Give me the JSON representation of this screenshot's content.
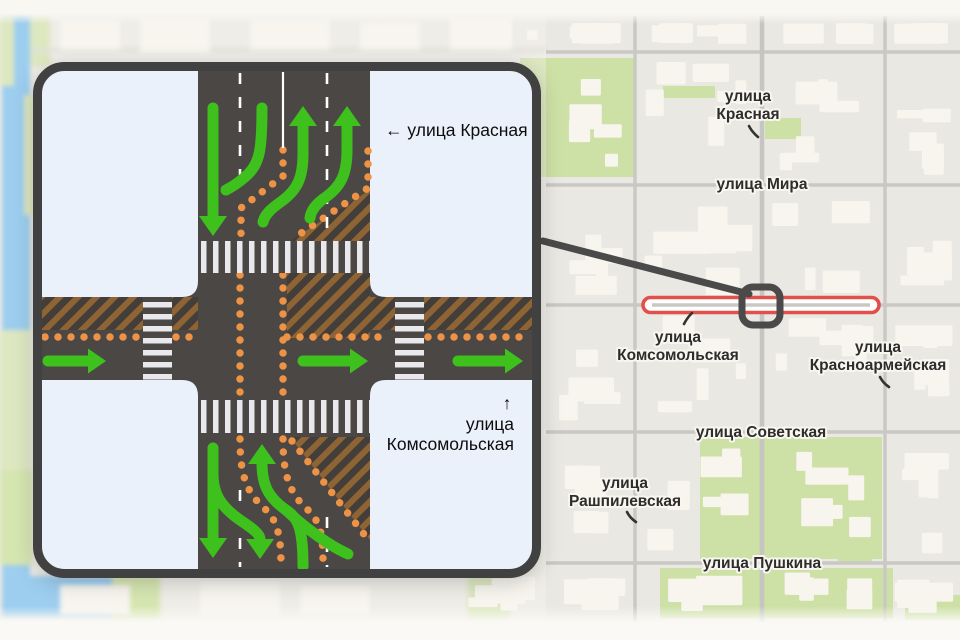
{
  "inset": {
    "label_krasnaya": "← улица Красная",
    "label_komsomolskaya_arrow": "↑",
    "label_komsomolskaya_line1": "улица",
    "label_komsomolskaya_line2": "Комсомольская"
  },
  "map": {
    "label_krasnaya_line1": "улица",
    "label_krasnaya_line2": "Красная",
    "label_mira": "улица Мира",
    "label_komsomolskaya_line1": "улица",
    "label_komsomolskaya_line2": "Комсомольская",
    "label_krasnoarmeyskaya_line1": "улица",
    "label_krasnoarmeyskaya_line2": "Красноармейская",
    "label_sovetskaya": "улица Советская",
    "label_rashpilevskaya_line1": "улица",
    "label_rashpilevskaya_line2": "Рашпилевская",
    "label_pushkina": "улица Пушкина"
  },
  "colors": {
    "highlight_red": "#e2504c",
    "arrow_green": "#3fc11d",
    "buffer_orange": "#ee9346",
    "road_dark": "#4a4745",
    "marker_gray": "#4a4a4a",
    "hatch_brown": "#8f6434",
    "park_green": "#cde0a5",
    "water_blue": "#66b6ef",
    "map_background": "#eae8e2",
    "building_fill": "#f7f5ee",
    "inset_background": "#ebf1fa"
  }
}
